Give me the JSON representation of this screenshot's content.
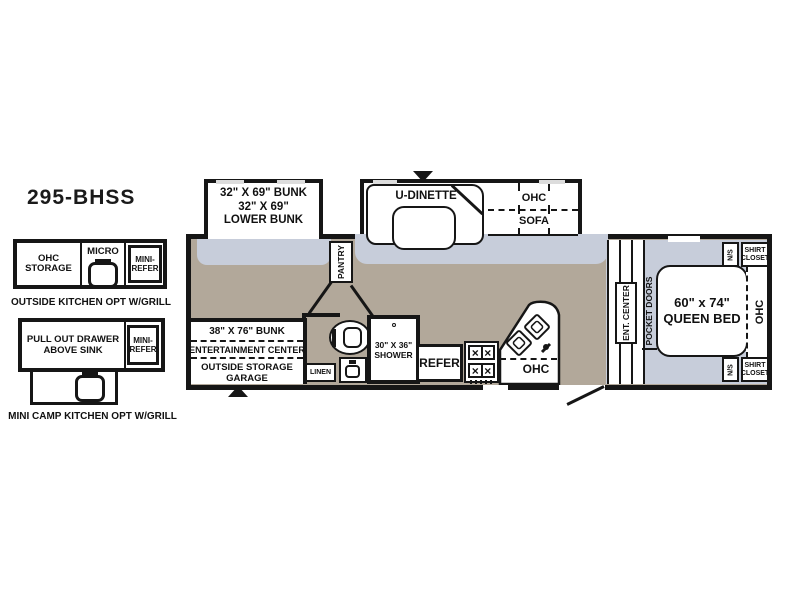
{
  "title": "295-BHSS",
  "colors": {
    "floor_main": "#b2a89a",
    "floor_slide": "#c7cdda",
    "wall": "#161616",
    "window": "#dcdcdc"
  },
  "options": {
    "outside_kitchen": {
      "caption": "OUTSIDE KITCHEN OPT W/GRILL",
      "ohc_storage": "OHC STORAGE",
      "micro": "MICRO",
      "mini_refer": "MINI-REFER"
    },
    "mini_camp_kitchen": {
      "caption": "MINI CAMP KITCHEN OPT W/GRILL",
      "pull_out_drawer": "PULL OUT DRAWER ABOVE SINK",
      "mini_refer": "MINI-REFER"
    }
  },
  "slides": {
    "bunk_slide": {
      "line1": "32\" X 69\" BUNK",
      "line2": "32\" X 69\"",
      "line3": "LOWER BUNK"
    },
    "dinette_slide": {
      "dinette": "U-DINETTE",
      "ohc": "OHC",
      "sofa": "SOFA"
    }
  },
  "interior": {
    "pantry": "PANTRY",
    "bunk": "38\" X 76\" BUNK",
    "entertainment_center": "ENTERTAINMENT CENTER",
    "outside_storage": "OUTSIDE STORAGE GARAGE",
    "linen": "LINEN",
    "shower": "30\" X 36\" SHOWER",
    "refer": "REFER",
    "kitchen_ohc": "OHC",
    "ent_center": "ENT. CENTER",
    "pocket_doors": "POCKET DOORS"
  },
  "bedroom": {
    "bed_line1": "60\" x 74\"",
    "bed_line2": "QUEEN BED",
    "ohc": "OHC",
    "nightstand": "N/S",
    "shirt_closet": "SHIRT CLOSET"
  }
}
